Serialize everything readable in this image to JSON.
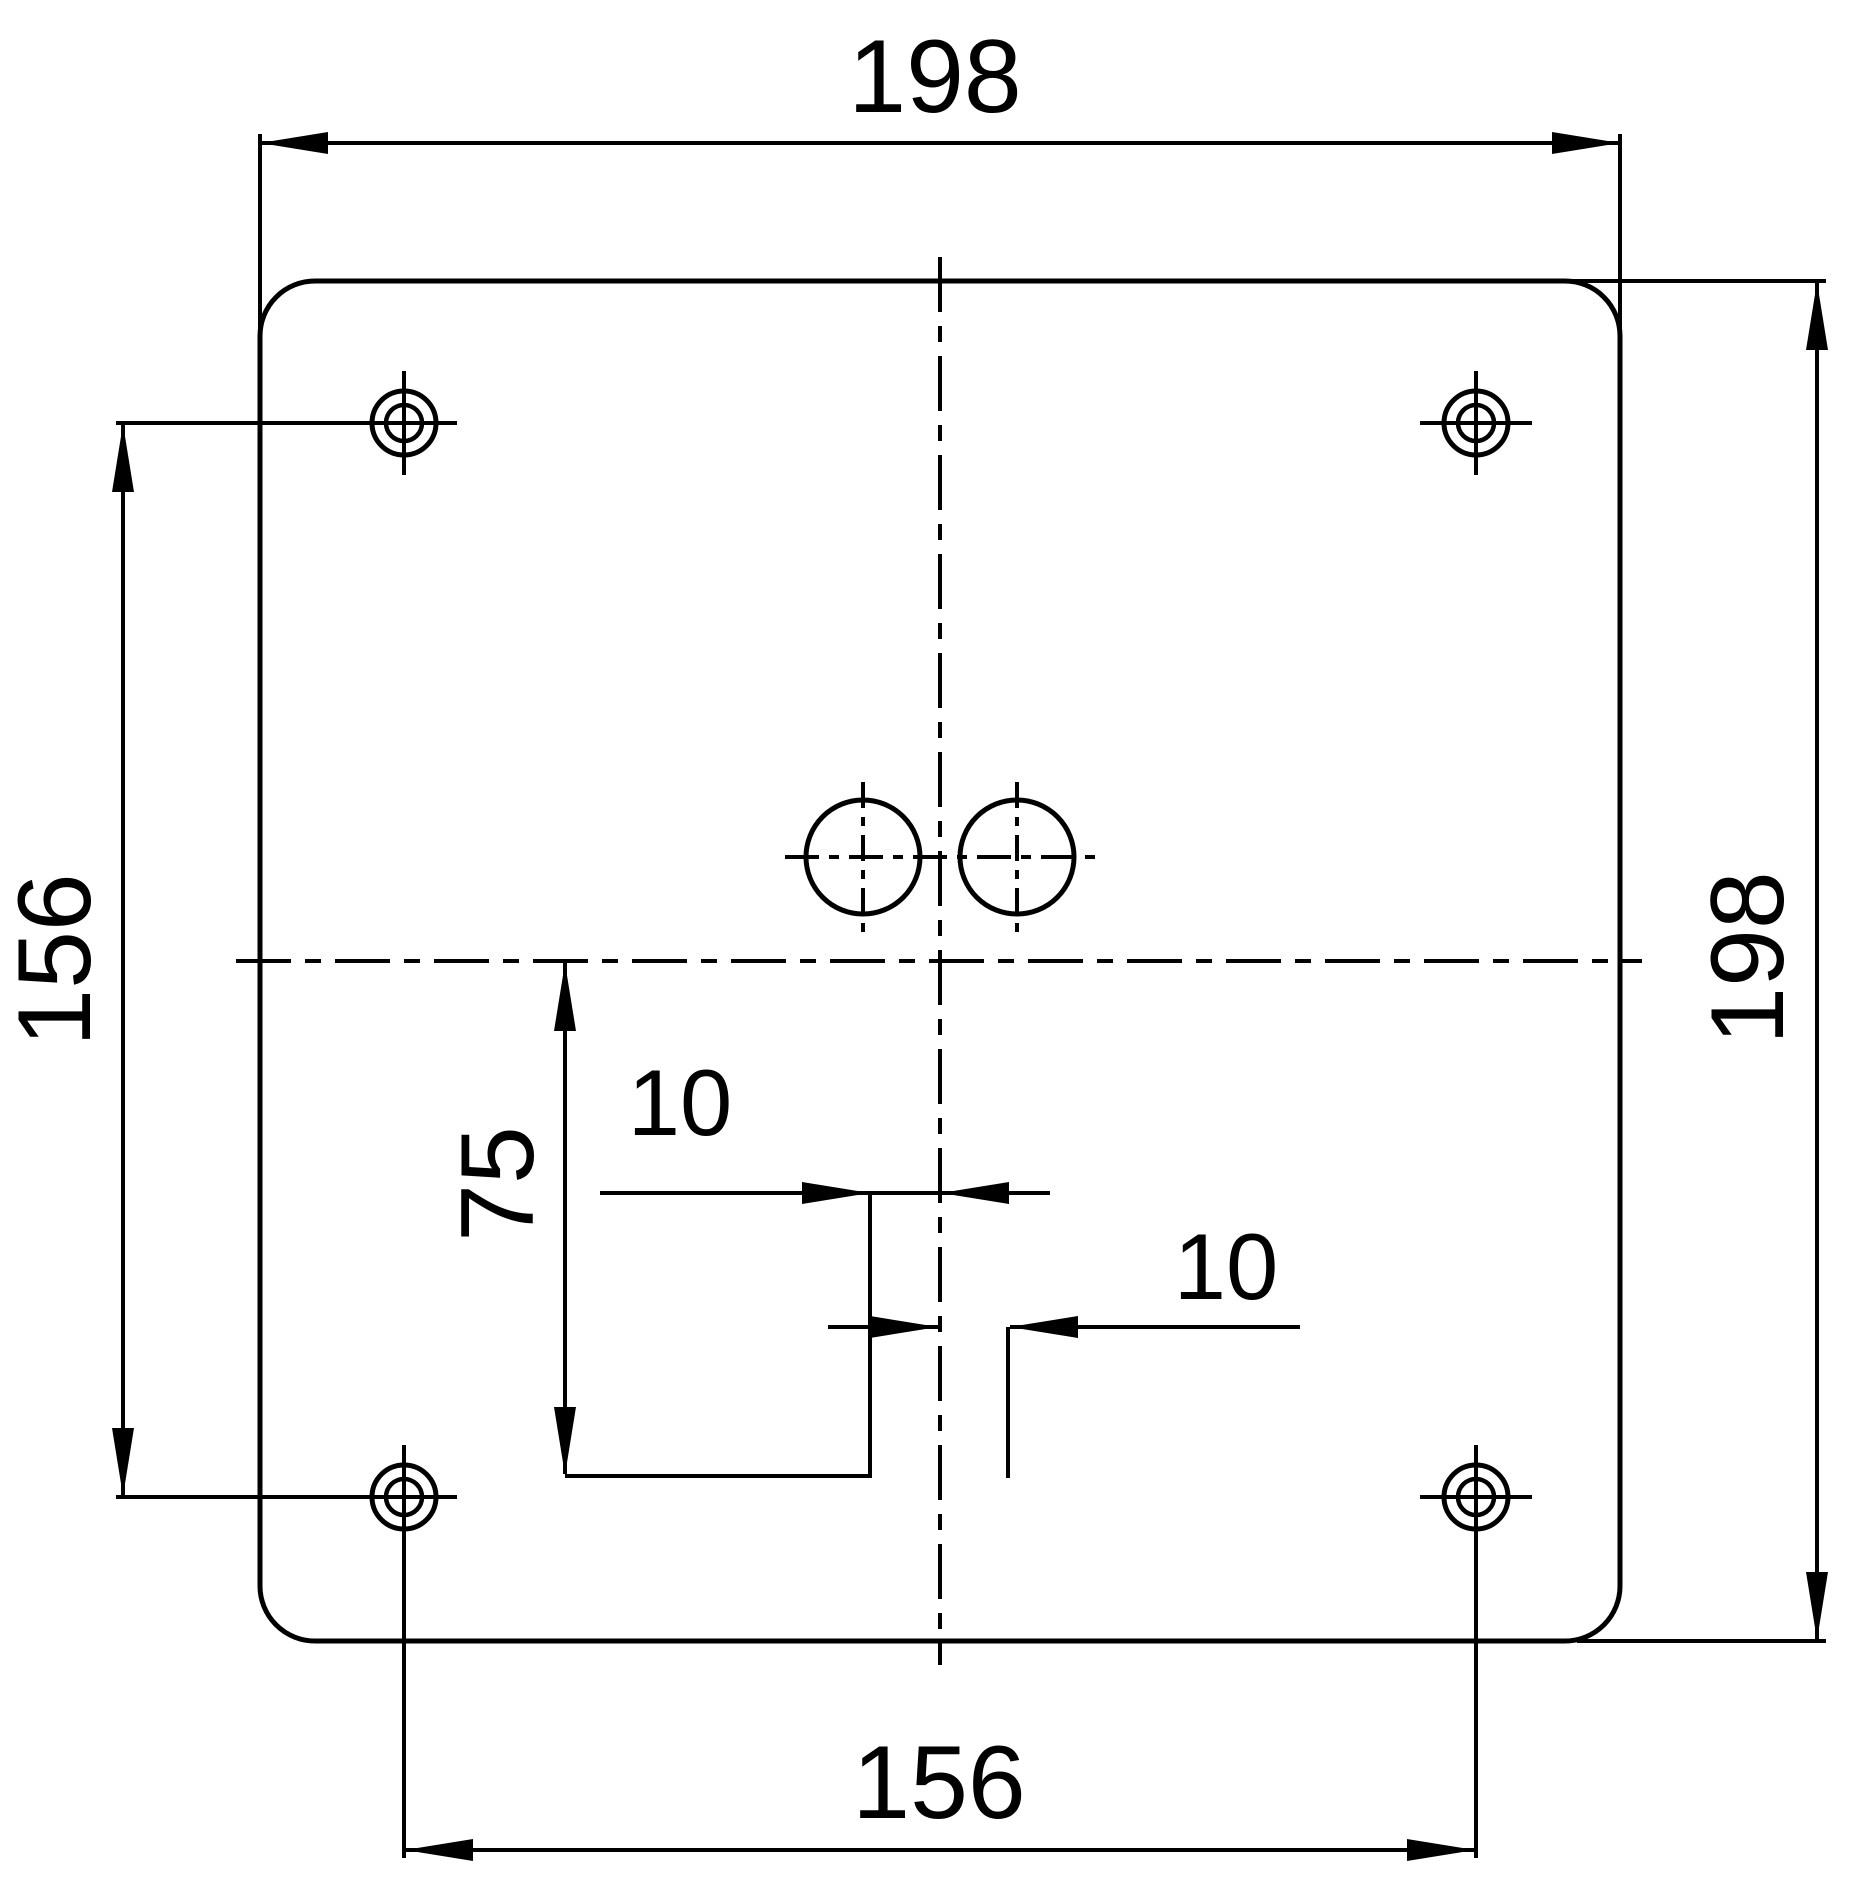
{
  "drawing": {
    "title": "mounting-plate-dimension-drawing",
    "colors": {
      "line": "#000000",
      "background": "#ffffff"
    },
    "features": {
      "corner_holes": 4,
      "center_knockouts": 2
    },
    "dimensions": {
      "top_width": "198",
      "right_height": "198",
      "left_hole_pitch": "156",
      "bottom_hole_pitch": "156",
      "vertical_offset": "75",
      "offset_left_of_center": "10",
      "offset_right_of_center": "10"
    }
  }
}
